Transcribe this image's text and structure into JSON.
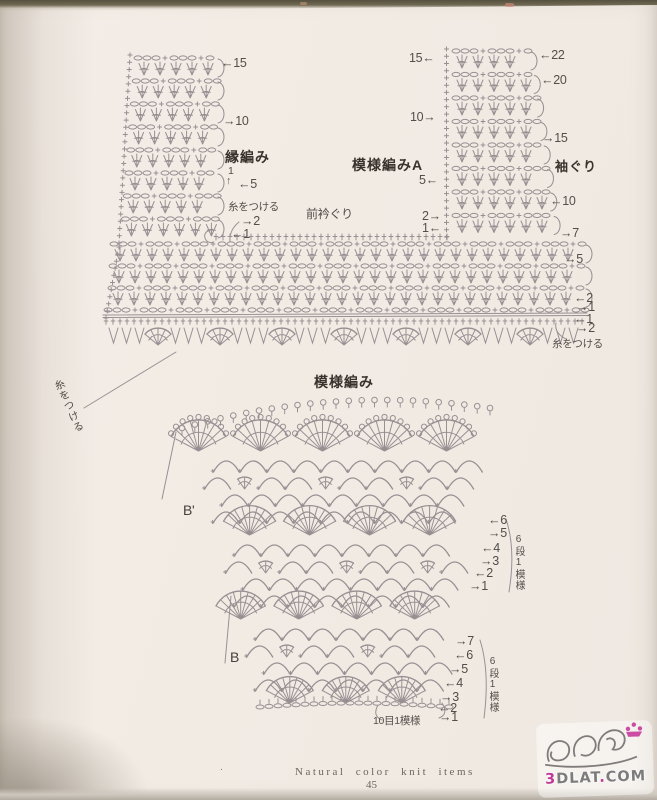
{
  "colors": {
    "diagram_stroke": "#998f93",
    "annotation_text": "#534e4a",
    "bold_label_text": "#38322c",
    "watermark_pink": "#c03a9a",
    "watermark_gray": "#7c7c7c"
  },
  "diagram1": {
    "edge_band": {
      "title": "縁編み",
      "rows": [
        "←15",
        "→10",
        "1",
        "↑",
        "←5",
        "→2",
        "←1"
      ],
      "attach_yarn": "糸をつける"
    },
    "pattern_a": {
      "title": "模様編みA",
      "rows": [
        "15←",
        "10→",
        "5←",
        "2→",
        "1←"
      ],
      "front_neckline": "前衿ぐり"
    },
    "armhole": {
      "label": "袖ぐり",
      "rows": [
        "←22",
        "←20",
        "→15",
        "←10",
        "→7"
      ]
    },
    "body": {
      "rows": [
        "→5",
        "←2",
        "→1",
        "←1",
        "→2"
      ],
      "attach_yarn": "糸をつける"
    },
    "attach_yarn_left": "糸をつける"
  },
  "diagram2": {
    "title": "模様編み",
    "marker_b_prime": "B'",
    "marker_b": "B",
    "upper_rows": [
      "←6",
      "→5",
      "←4",
      "→3",
      "←2",
      "→1"
    ],
    "upper_repeat": "6段1模様",
    "lower_rows": [
      "→7",
      "←6",
      "→5",
      "←4",
      "→3",
      "←2",
      "→1"
    ],
    "lower_repeat": "6段1模様",
    "stitch_repeat": "10目1模様"
  },
  "footer": {
    "series_title": "Natural color knit items",
    "page_number": "45",
    "dot": "."
  },
  "watermark": {
    "site": "3DLAT.COM",
    "part_3": "3",
    "part_dlat": "DLAT",
    "part_dot": ".",
    "part_com": "COM"
  }
}
